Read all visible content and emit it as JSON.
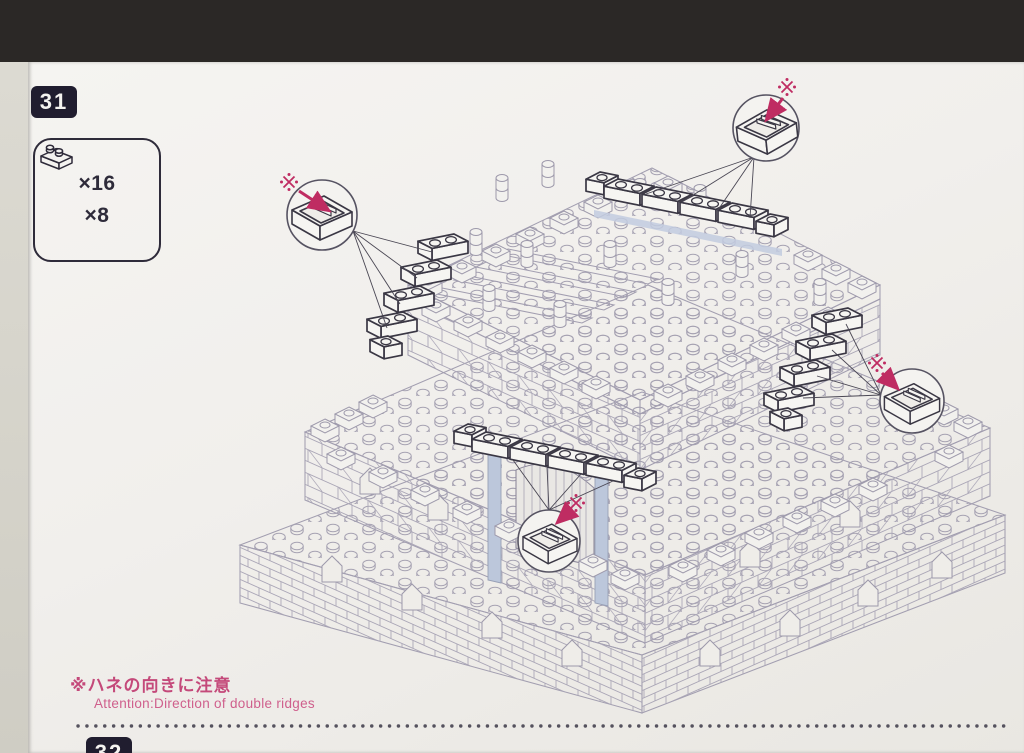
{
  "step": {
    "number": "31"
  },
  "next_step": {
    "number": "32"
  },
  "parts_box": {
    "items": [
      {
        "piece_name": "1x1-plate",
        "count": "×16"
      },
      {
        "piece_name": "1x2-brick",
        "count": "×8"
      }
    ]
  },
  "note": {
    "jp": "※ハネの向きに注意",
    "en": "Attention:Direction of double ridges"
  },
  "callouts": {
    "mark": "※",
    "description_piece_view": "underside of piece showing double ridges",
    "count": 4
  },
  "colors": {
    "accent_pink": "#bf2c62",
    "note_pink": "#c4497a",
    "ink_dark": "#3a3744",
    "line_gray": "#a29eb0",
    "highlight_blue": "#bcc7db",
    "page": "#f1efec",
    "backdrop": "#2b2826"
  }
}
